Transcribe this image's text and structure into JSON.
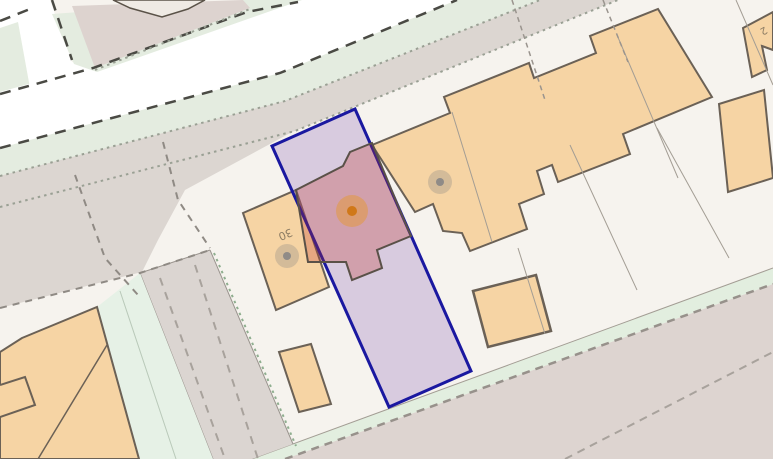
{
  "map": {
    "type": "cadastral-parcel-map",
    "labels": {
      "house_number_30": "30",
      "house_number_partial": "2"
    },
    "selected_parcel": {
      "outline_color": "#1a18a0",
      "fill_color": "rgba(147,112,190,0.30)"
    },
    "selected_building": {
      "highlight_color": "rgba(190,50,40,0.28)",
      "marker": "orange-dot-marker"
    },
    "markers": [
      {
        "name": "selected-building-marker",
        "color": "#d07818"
      },
      {
        "name": "building-30-marker",
        "color": "#8f8b87"
      },
      {
        "name": "neighbor-building-marker",
        "color": "#8f8b87"
      }
    ],
    "colors": {
      "background": "#f6f3ee",
      "road": "#ffffff",
      "paved_area": "#dcd6d1",
      "green_verge": "#e4ece0",
      "building_fill": "#f6d4a4",
      "building_outline": "#6b6156",
      "road_edge_dash": "#4a4a44"
    }
  }
}
